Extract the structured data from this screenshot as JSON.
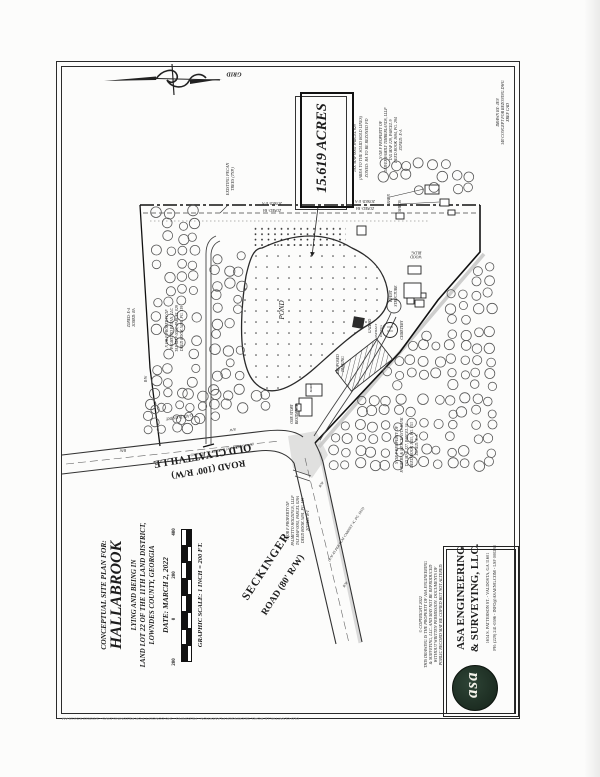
{
  "compass": {
    "label": "GRID"
  },
  "acreage": {
    "acres": "15.619 ACRES",
    "notes": [
      "TAX MAP 0092 PARCEL 029",
      "(AREA TO THE SOLID BOLD LINES)",
      "ZONED: RA TO BE REZONED PD"
    ]
  },
  "labels": {
    "pecan_1": "EXISTING PECAN",
    "pecan_2": "TREES (TYP.)",
    "pond": "POND",
    "gazebo": "GAZEBO",
    "event_1": "EVENT",
    "event_2": "STRUCTURE",
    "wood_1": "WOOD",
    "wood_2": "BLDG.",
    "cemetery": "CEMETERY",
    "asphalt_1": "ASPHALT",
    "asphalt_2": "PAVING",
    "barn": "BARN",
    "sheds": "SHEDS",
    "barn2": "BARN",
    "residence_1": "ONE STORY",
    "residence_2": "RESIDENCE",
    "parking_1": "PROPOSED",
    "parking_2": "PARKING",
    "gated": "GATED ENTRY",
    "zoned_ea": "ZONED: E-A",
    "zoned_ra": "ZONED: RA",
    "rw": "R/W"
  },
  "roads": {
    "seckinger_1": "SECKINGER",
    "seckinger_2": "ROAD (80' R/W)",
    "old_1": "OLD CLYATTVILLE",
    "old_2": "ROAD (100' R/W)",
    "rw_note": "(R/W AS PER PLAT CABINET 'A', PG. 1832)"
  },
  "parcels": {
    "oliver": [
      "N OR F PROPERTY OF",
      "OLIVER FAMILY TIMBERLANDS, LLLP",
      "TAX MAP 129, PARCEL 9",
      "DEED BOOK 1694, PG. 294",
      "ZONED: E-A"
    ],
    "pecan": [
      "N OR F PROPERTY OF",
      "PALMETTO PECAN, LLC",
      "TAX MAP 0092, PARCEL 029",
      "DEED BOOK 5491, PG. 119"
    ],
    "fmb": [
      "N OR F PROPERTY OF",
      "FARMERS & MERCHANTS BANK",
      "TAX MAP 127, PARCEL 34",
      "DEED BOOK 1453, PG. 153",
      "ZONED: E-A"
    ],
    "holdings": [
      "N OR F PROPERTY OF",
      "PALMETTO HOLDINGS, LLLP",
      "TAX MAP 0092, PARCEL 029A",
      "DEED BOOK 5491, PG. 119",
      "ZONED: R-1"
    ]
  },
  "title_block": {
    "heading": "CONCEPTUAL SITE PLAN FOR:",
    "project": "HALLABROOK",
    "line1": "LYING AND BEING IN",
    "line2": "LAND LOT 22 OF THE 11TH LAND DISTRICT,",
    "line3": "LOWNDES COUNTY, GEORGIA",
    "date": "DATE: MARCH 2, 2022"
  },
  "scale_bar": {
    "caption": "GRAPHIC SCALE: 1 INCH = 200 FT.",
    "ticks": [
      "400",
      "200",
      "0",
      "200"
    ]
  },
  "firm": {
    "name1": "ASA ENGINEERING",
    "name2": "& SURVEYING, LLC.",
    "address": "1634 S. PATTERSON ST.  -  VALDOSTA, GA 31601",
    "phone": "PH: (229) 241-0596 - INFO@ASAENG.COM - LSF 000288",
    "logo_text": "asa"
  },
  "copyright": {
    "line0": "© COPYRIGHT  2022",
    "line1": "THIS DRAWING IS THE PROPERTY OF ASA ENGINEERING",
    "line2": "& SURVEYING, LLC. AND MAY NOT BE REPRODUCED",
    "line3": "WITHOUT WRITTEN PERMISSION. DOCUMENTS OF",
    "line4": "PUBLIC RECORD MAY BE COPIED BUT NOT ALTERED."
  },
  "sheet_notes": {
    "drawn_by": "DRAWN BY: JEN",
    "file": "340 CONCEPT FOR REZONING.DWG",
    "cad": "XREF CAD"
  },
  "plot_stamp": "OLD CLYATTVILLE ROAD, SECKINGER PLANTATION - REZONING - 340 CONCEPT FOR REZONING.DWG - 3/2/2022 9:53:19 AM"
}
